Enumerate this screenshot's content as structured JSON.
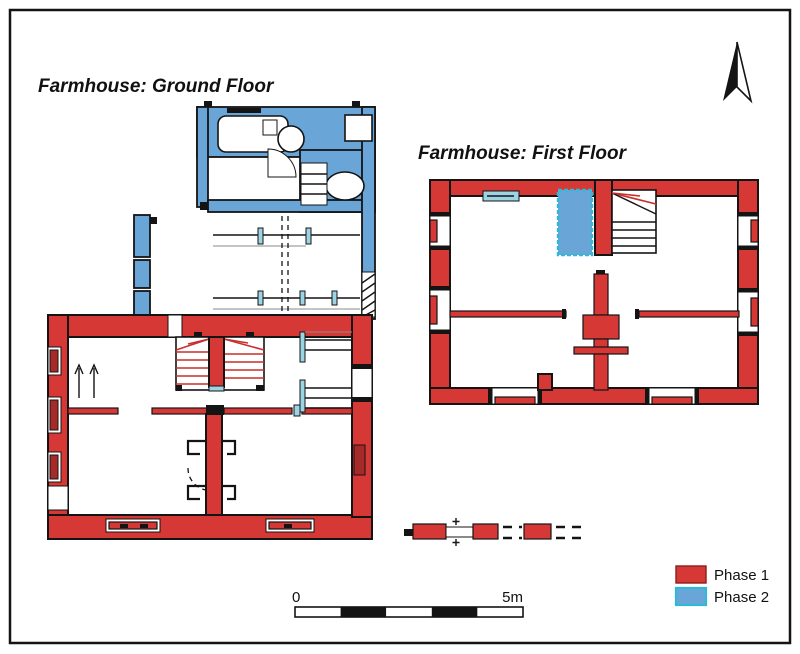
{
  "plans": {
    "ground_floor": {
      "title": "Farmhouse: Ground Floor"
    },
    "first_floor": {
      "title": "Farmhouse: First Floor"
    }
  },
  "scale_bar": {
    "start_label": "0",
    "end_label": "5m",
    "segments": 5
  },
  "legend": {
    "items": [
      {
        "label": "Phase 1",
        "color": "#d63835",
        "border": "#8a1f1c"
      },
      {
        "label": "Phase 2",
        "color": "#6aa5d8",
        "border": "#2fb9d6"
      }
    ]
  },
  "colors": {
    "phase1": "#d63835",
    "phase1_dark": "#a62b28",
    "phase2": "#6aa5d8",
    "phase2_light": "#9cd4e4",
    "outline": "#141414",
    "stair_tread": "#c92f2c"
  }
}
